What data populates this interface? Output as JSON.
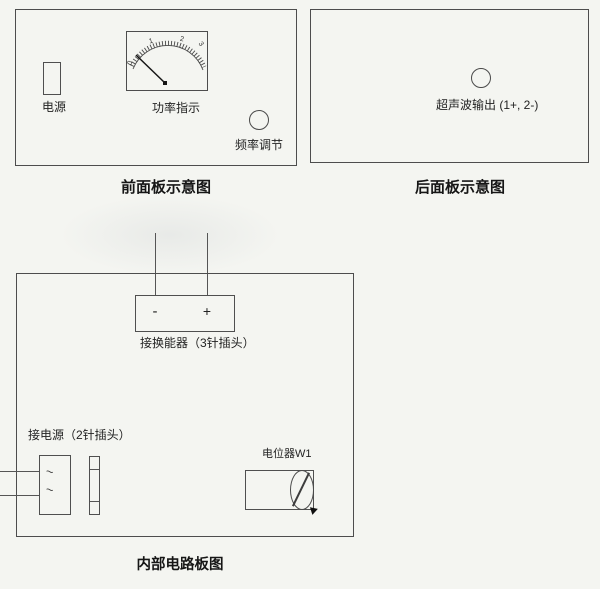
{
  "page": {
    "bg_color": "#f4f5f1",
    "line_color": "#4d4d4d",
    "text_color": "#1f1f1f"
  },
  "front_panel": {
    "caption": "前面板示意图",
    "power_label": "电源",
    "meter_label": "功率指示",
    "freq_label": "频率调节",
    "meter_scale": [
      "0",
      "1",
      "2",
      "3"
    ]
  },
  "rear_panel": {
    "caption": "后面板示意图",
    "output_label": "超声波输出 (1+, 2-)"
  },
  "circuit_board": {
    "caption": "内部电路板图",
    "transducer_label": "接换能器（3针插头）",
    "pin_minus": "-",
    "pin_plus": "+",
    "power_conn_label": "接电源（2针插头）",
    "pin_mark_1": "~",
    "pin_mark_2": "~",
    "pot_label": "电位器W1"
  }
}
